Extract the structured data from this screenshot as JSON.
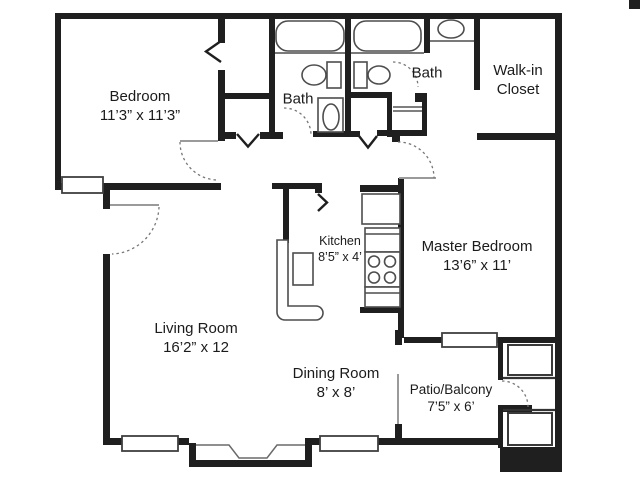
{
  "rooms": {
    "bedroom": {
      "name": "Bedroom",
      "dims": "11’3” x 11’3”"
    },
    "bath1": {
      "name": "Bath"
    },
    "bath2": {
      "name": "Bath"
    },
    "walk_in_closet": {
      "name": "Walk-in Closet"
    },
    "kitchen": {
      "name": "Kitchen",
      "dims": "8’5” x 4’"
    },
    "master_bedroom": {
      "name": "Master Bedroom",
      "dims": "13’6” x 11’"
    },
    "living_room": {
      "name": "Living Room",
      "dims": "16’2” x 12"
    },
    "dining_room": {
      "name": "Dining Room",
      "dims": "8’ x 8’"
    },
    "patio": {
      "name": "Patio/Balcony",
      "dims": "7’5” x 6’"
    }
  },
  "colors": {
    "background": "#ffffff",
    "wall": "#1f1f1f",
    "fixture_outline": "#4d4d4d",
    "door_leaf": "#9a9a9a",
    "door_swing": "#777777",
    "label_text": "#1b1b1b"
  }
}
